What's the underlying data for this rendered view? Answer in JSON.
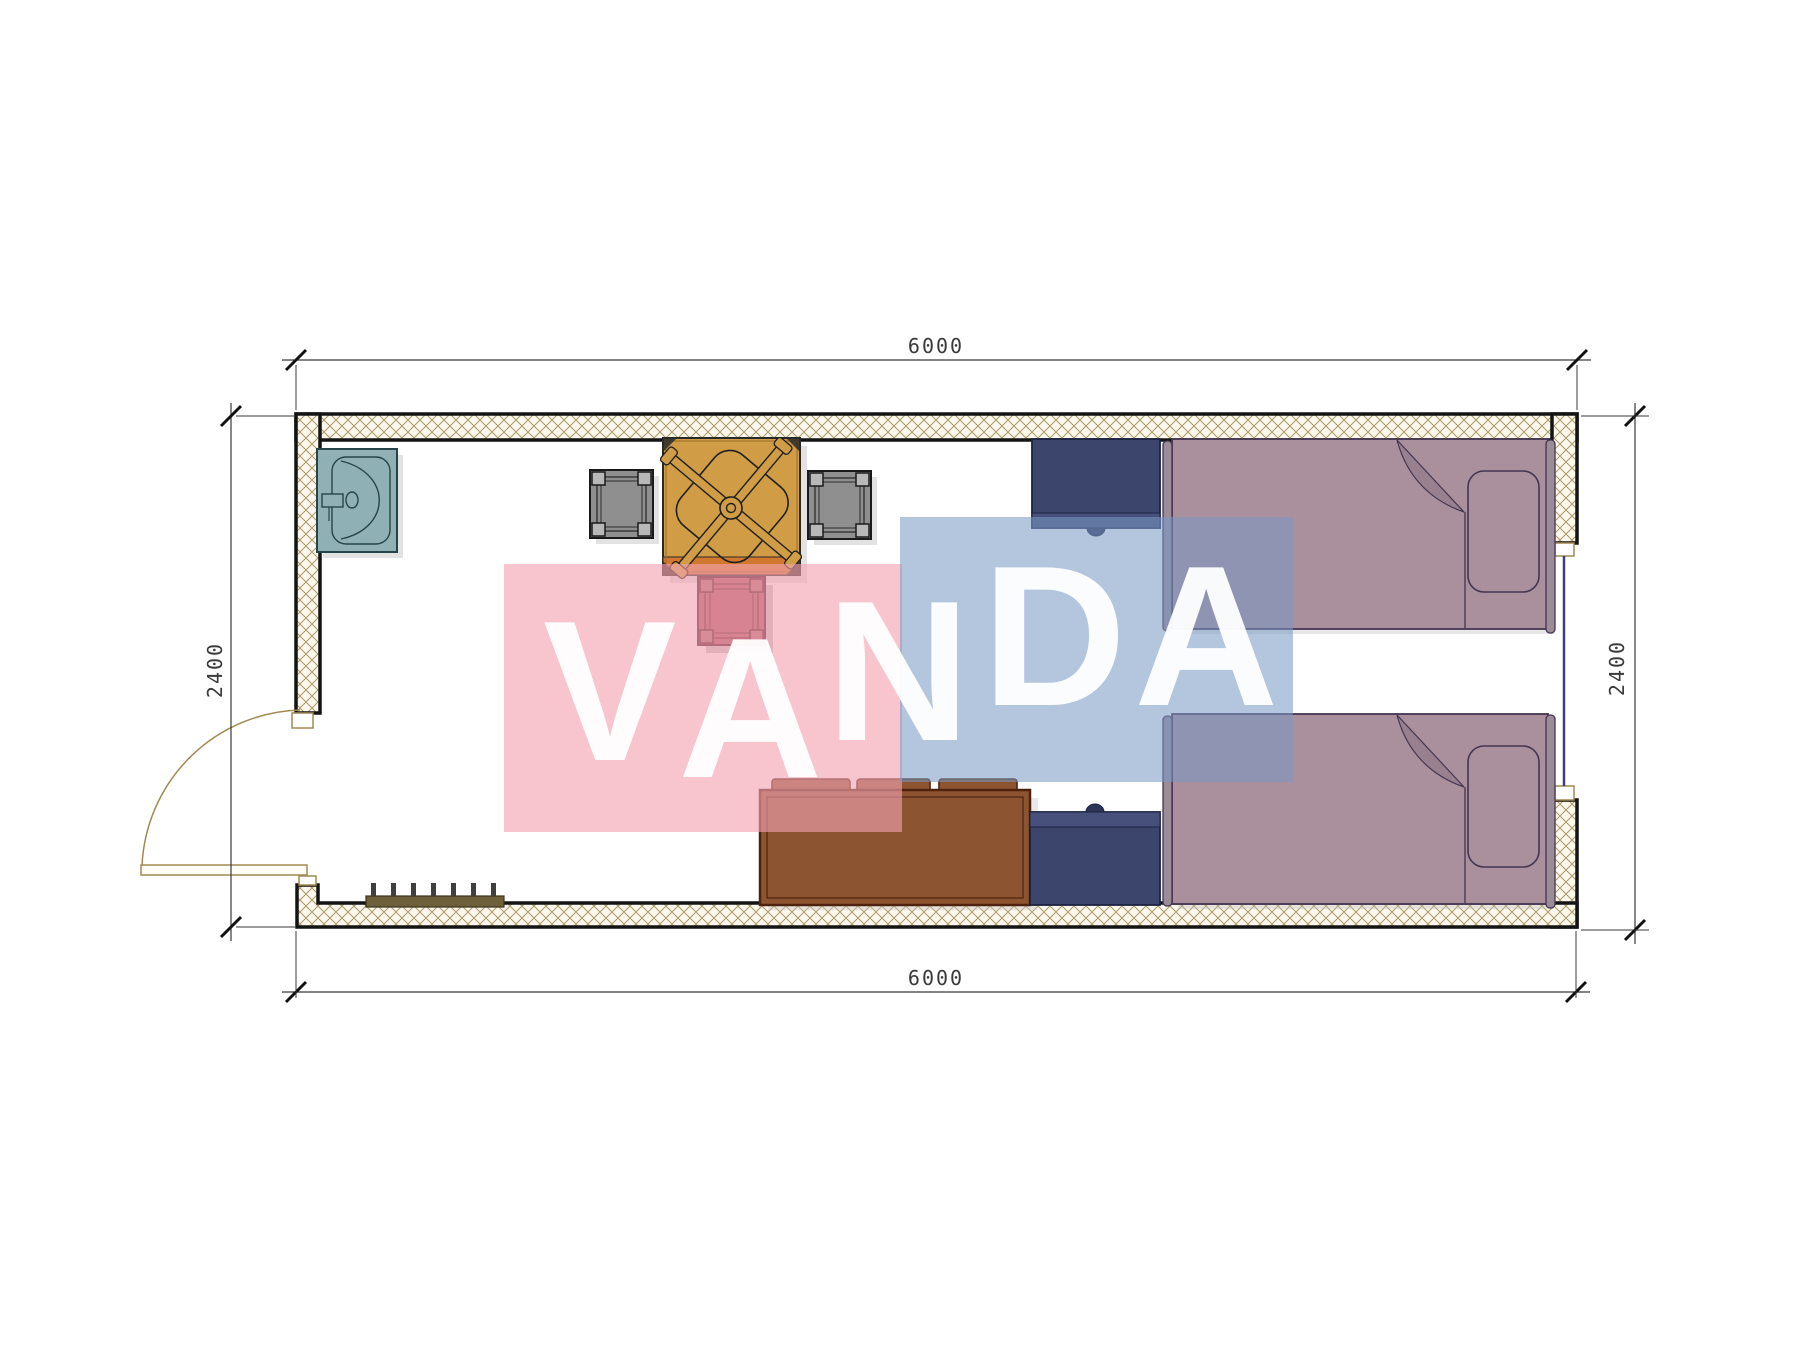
{
  "document": {
    "type": "architectural-floor-plan"
  },
  "dimensions": {
    "top": "6000",
    "bottom": "6000",
    "left": "2400",
    "right": "2400"
  },
  "watermark": {
    "text": "VANDA",
    "letters": [
      "V",
      "A",
      "N",
      "D",
      "A"
    ],
    "pink_square_color": "#f4a2b1",
    "blue_square_color": "#7998c5",
    "letter_color": "#ffffff"
  },
  "walls": {
    "hatch_color": "#ab9a68",
    "hatch_background": "#fbf7ec",
    "outline_color": "#141414",
    "door_frame_color": "#a08a50",
    "window_glass_color": "#3b4080"
  },
  "furniture": [
    {
      "name": "sink",
      "color": "#8fb0b4"
    },
    {
      "name": "stool-left",
      "color": "#8f8f8f"
    },
    {
      "name": "stool-right",
      "color": "#8f8f8f"
    },
    {
      "name": "desk",
      "color": "#d09c45"
    },
    {
      "name": "office-chair",
      "color": "#1f1f1f"
    },
    {
      "name": "side-table",
      "color": "#a8525c"
    },
    {
      "name": "sofa",
      "color": "#8c5431"
    },
    {
      "name": "nightstand-upper",
      "color": "#3c456c"
    },
    {
      "name": "nightstand-lower",
      "color": "#3c456c"
    },
    {
      "name": "bed-upper",
      "color": "#a9909c"
    },
    {
      "name": "bed-lower",
      "color": "#a9909c"
    },
    {
      "name": "shoe-rack",
      "color": "#6f603c"
    },
    {
      "name": "entry-door"
    },
    {
      "name": "window"
    }
  ]
}
